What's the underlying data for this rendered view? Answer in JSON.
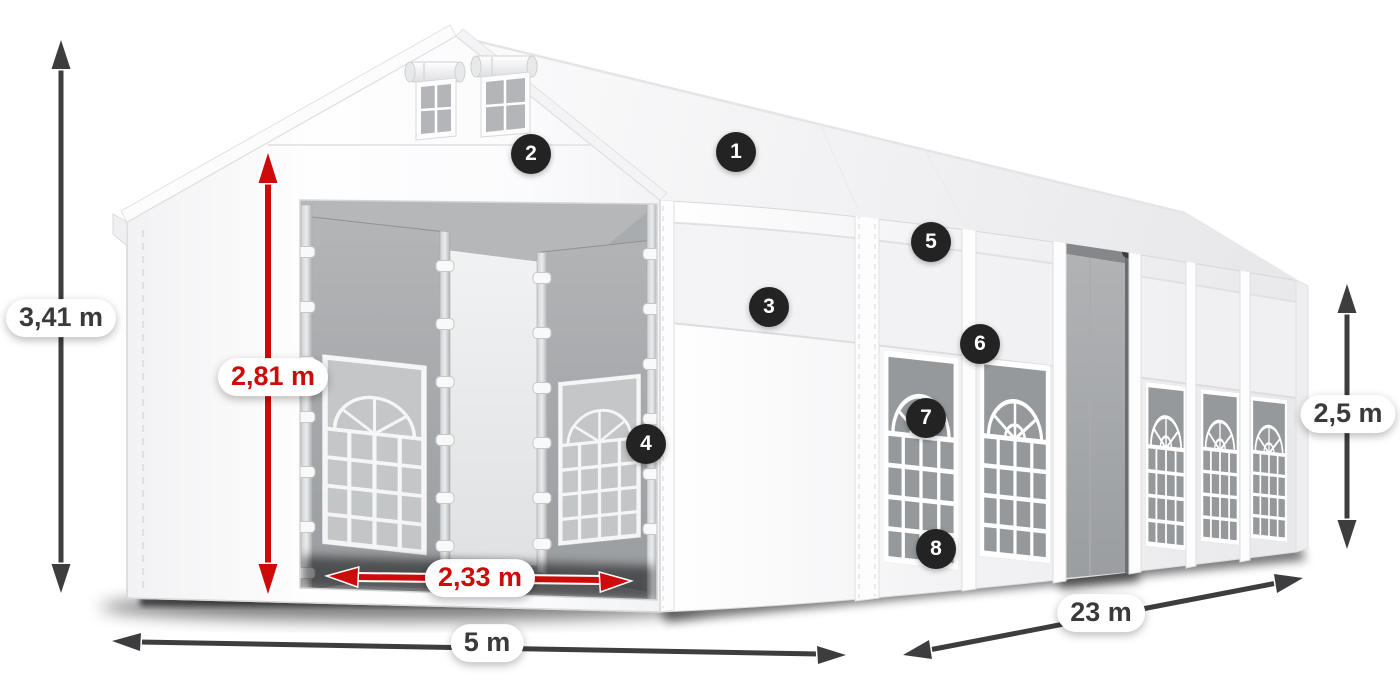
{
  "figure": {
    "subject": "white party tent shown in 3D with dimension annotations and numbered feature hotspots",
    "view": "front-left product render"
  },
  "colors": {
    "background": "#ffffff",
    "tent_fabric": "#fafafb",
    "dimension_arrow_gray": "#3d3d3f",
    "dimension_text_gray": "#3a3a3c",
    "dimension_accent_red": "#ce0b0b",
    "callout_background": "#232324",
    "callout_text": "#ffffff"
  },
  "dimensions": [
    {
      "id": "total-height",
      "label": "3,41 m",
      "style": "gray",
      "orientation": "vertical"
    },
    {
      "id": "entrance-clear-height",
      "label": "2,81 m",
      "style": "red",
      "orientation": "vertical"
    },
    {
      "id": "entrance-clear-width",
      "label": "2,33 m",
      "style": "red",
      "orientation": "horizontal"
    },
    {
      "id": "front-width",
      "label": "5 m",
      "style": "gray",
      "orientation": "horizontal"
    },
    {
      "id": "side-length",
      "label": "23 m",
      "style": "gray",
      "orientation": "diagonal"
    },
    {
      "id": "side-wall-height",
      "label": "2,5 m",
      "style": "gray",
      "orientation": "vertical"
    }
  ],
  "callouts": [
    {
      "number": "1"
    },
    {
      "number": "2"
    },
    {
      "number": "3"
    },
    {
      "number": "4"
    },
    {
      "number": "5"
    },
    {
      "number": "6"
    },
    {
      "number": "7"
    },
    {
      "number": "8"
    }
  ]
}
